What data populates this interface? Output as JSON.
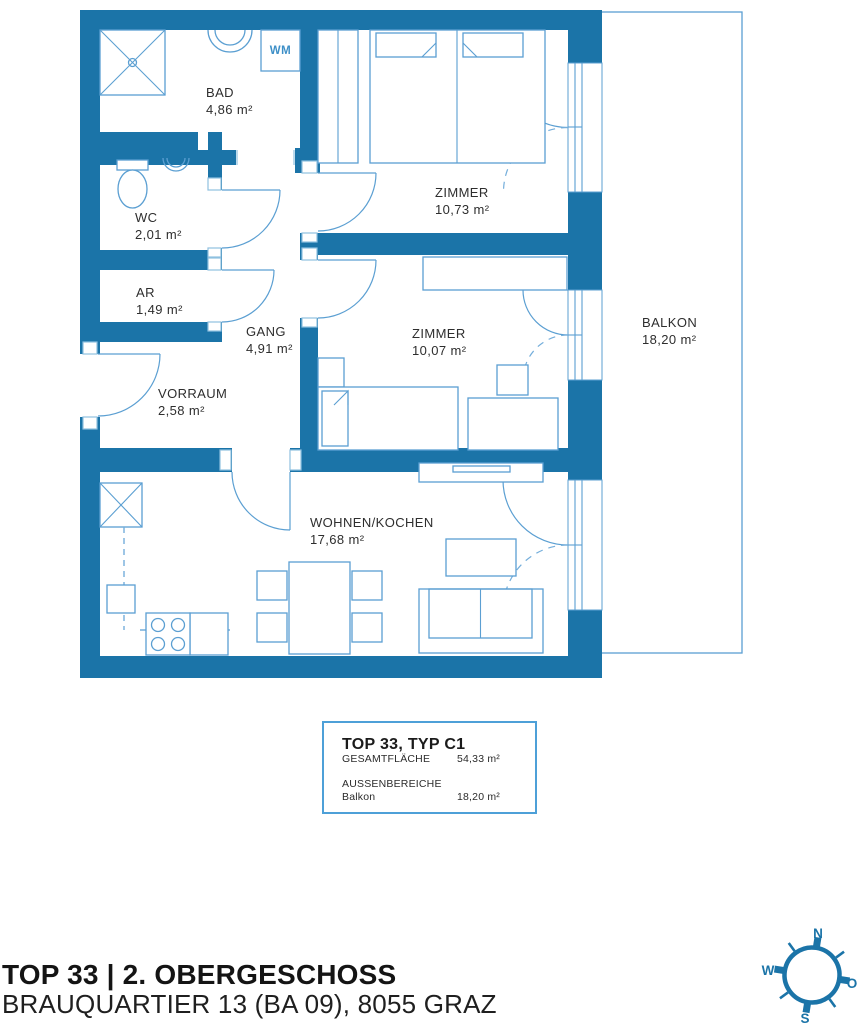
{
  "rooms": {
    "bad": {
      "name": "BAD",
      "area": "4,86 m²"
    },
    "wc": {
      "name": "WC",
      "area": "2,01 m²"
    },
    "ar": {
      "name": "AR",
      "area": "1,49 m²"
    },
    "gang": {
      "name": "GANG",
      "area": "4,91 m²"
    },
    "vorraum": {
      "name": "VORRAUM",
      "area": "2,58 m²"
    },
    "zimmer1": {
      "name": "ZIMMER",
      "area": "10,73 m²"
    },
    "zimmer2": {
      "name": "ZIMMER",
      "area": "10,07 m²"
    },
    "wohnen": {
      "name": "WOHNEN/KOCHEN",
      "area": "17,68 m²"
    },
    "balkon": {
      "name": "BALKON",
      "area": "18,20 m²"
    }
  },
  "appliances": {
    "washing_machine": "WM"
  },
  "info_box": {
    "title": "TOP 33, TYP C1",
    "total_label": "GESAMTFLÄCHE",
    "total_value": "54,33 m²",
    "outdoor_label": "AUSSENBEREICHE",
    "outdoor_item": "Balkon",
    "outdoor_value": "18,20 m²"
  },
  "footer": {
    "title": "TOP 33 | 2. OBERGESCHOSS",
    "subtitle": "BRAUQUARTIER 13 (BA 09), 8055 GRAZ"
  },
  "compass": {
    "north": "N",
    "west": "W",
    "east": "O",
    "south": "S"
  },
  "colors": {
    "wall_blue": "#1b74a8",
    "line_blue": "#5b9fd2",
    "label_dark": "#2e2e2e",
    "info_border_blue": "#4da0d8"
  }
}
